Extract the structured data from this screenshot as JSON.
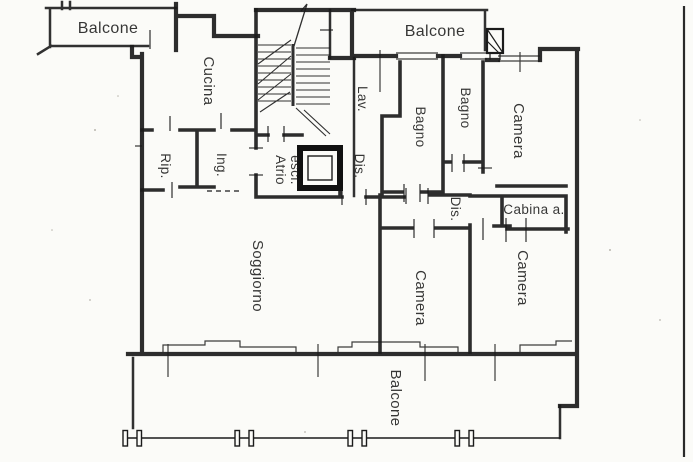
{
  "plan": {
    "paper_color": "#fbfbf8",
    "ink_color": "#1b1b1b",
    "labels": {
      "balcone_top_left": "Balcone",
      "balcone_top_right": "Balcone",
      "balcone_bottom": "Balcone",
      "cucina": "Cucina",
      "lav": "Lav.",
      "dis_1": "Dis.",
      "dis_2": "Dis.",
      "bagno_1": "Bagno",
      "bagno_2": "Bagno",
      "camera_top_right": "Camera",
      "camera_bottom_center": "Camera",
      "camera_bottom_right": "Camera",
      "rip": "Rip.",
      "ing": "Ing.",
      "atrio_line1": "Atrio",
      "atrio_line2": "escl.",
      "cabina": "Cabina a.",
      "soggiorno": "Soggiorno"
    }
  }
}
